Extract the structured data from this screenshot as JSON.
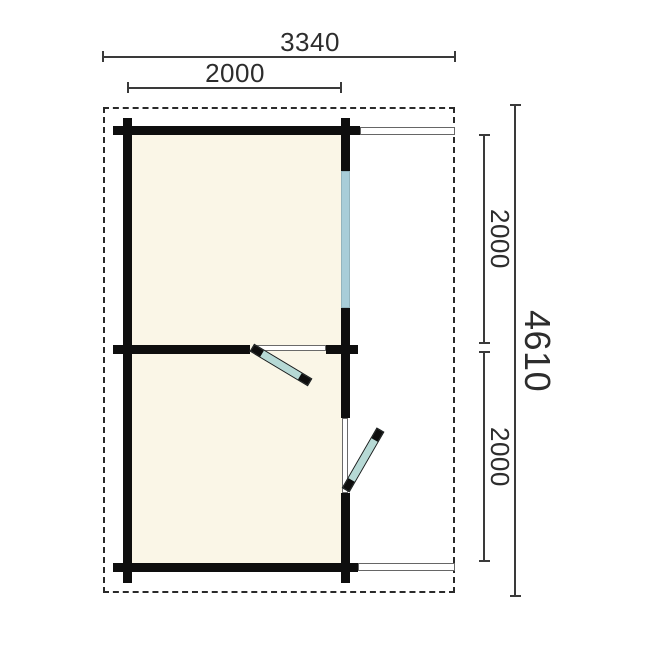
{
  "plan": {
    "type": "log-cabin-floor-plan",
    "unit": "mm",
    "labels": {
      "overall_width": "3340",
      "cabin_width": "2000",
      "overall_depth": "4610",
      "room_top_depth": "2000",
      "room_bottom_depth": "2000"
    },
    "colors": {
      "wall": "#0e0e0e",
      "floor": "#faf6e7",
      "window": "#a8cdd8",
      "door": "#b6d9d5",
      "dim": "#3a3a3a",
      "boundary": "#2a2a2a",
      "beam": "#666666",
      "text": "#2d2d2d",
      "bg": "#ffffff"
    }
  }
}
